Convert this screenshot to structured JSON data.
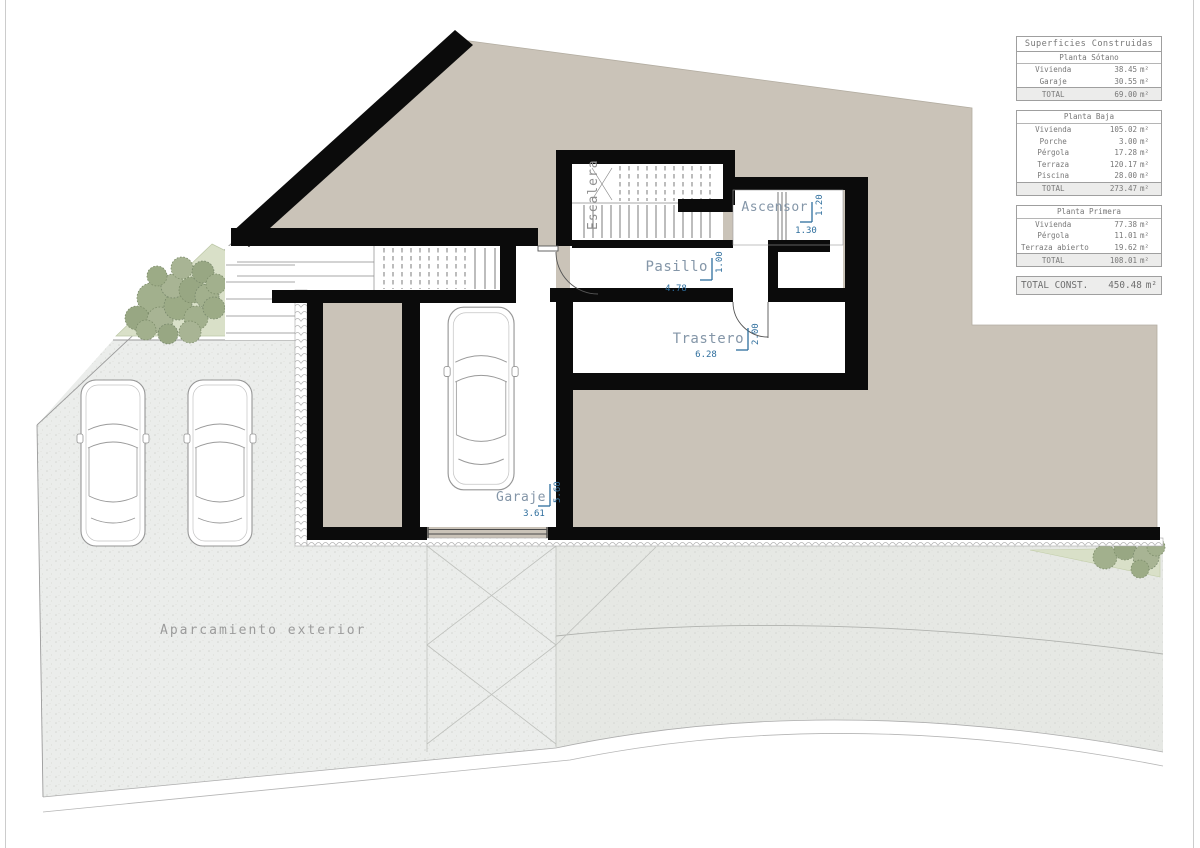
{
  "plan": {
    "labels": {
      "escalera": "Escalera",
      "ascensor": "Ascensor",
      "pasillo": "Pasillo",
      "trastero": "Trastero",
      "garaje": "Garaje",
      "aparcamiento": "Aparcamiento  exterior"
    },
    "dimensions": {
      "ascensor_w": "1.30",
      "ascensor_h": "1.20",
      "pasillo_w": "4.78",
      "pasillo_h": "1.00",
      "trastero_w": "6.28",
      "trastero_h": "2.00",
      "garaje_w": "3.61",
      "garaje_h": "5.60"
    },
    "colors": {
      "earth": "#cac3b8",
      "paving": "#ebedeb",
      "road": "#e6e8e4",
      "green": "#d9e0c8",
      "tree": "#a2b08d",
      "wall": "#0b0b0b",
      "dim_text": "#2e6e9d",
      "room_label": "#8496a8",
      "gray_label": "#9b9b9b"
    }
  },
  "tables": {
    "title": "Superficies  Construidas",
    "sections": [
      {
        "subtitle": "Planta  Sótano",
        "rows": [
          [
            "Vivienda",
            "38.45",
            "m²"
          ],
          [
            "Garaje",
            "30.55",
            "m²"
          ]
        ],
        "total": [
          "TOTAL",
          "69.00",
          "m²"
        ]
      },
      {
        "subtitle": "Planta  Baja",
        "rows": [
          [
            "Vivienda",
            "105.02",
            "m²"
          ],
          [
            "Porche",
            "3.00",
            "m²"
          ],
          [
            "Pérgola",
            "17.28",
            "m²"
          ],
          [
            "Terraza",
            "120.17",
            "m²"
          ],
          [
            "Piscina",
            "28.00",
            "m²"
          ]
        ],
        "total": [
          "TOTAL",
          "273.47",
          "m²"
        ]
      },
      {
        "subtitle": "Planta  Primera",
        "rows": [
          [
            "Vivienda",
            "77.38",
            "m²"
          ],
          [
            "Pérgola",
            "11.01",
            "m²"
          ],
          [
            "Terraza  abierto",
            "19.62",
            "m²"
          ]
        ],
        "total": [
          "TOTAL",
          "108.01",
          "m²"
        ]
      }
    ],
    "grand_total": {
      "label": "TOTAL  CONST.",
      "value": "450.48",
      "unit": "m²"
    }
  }
}
